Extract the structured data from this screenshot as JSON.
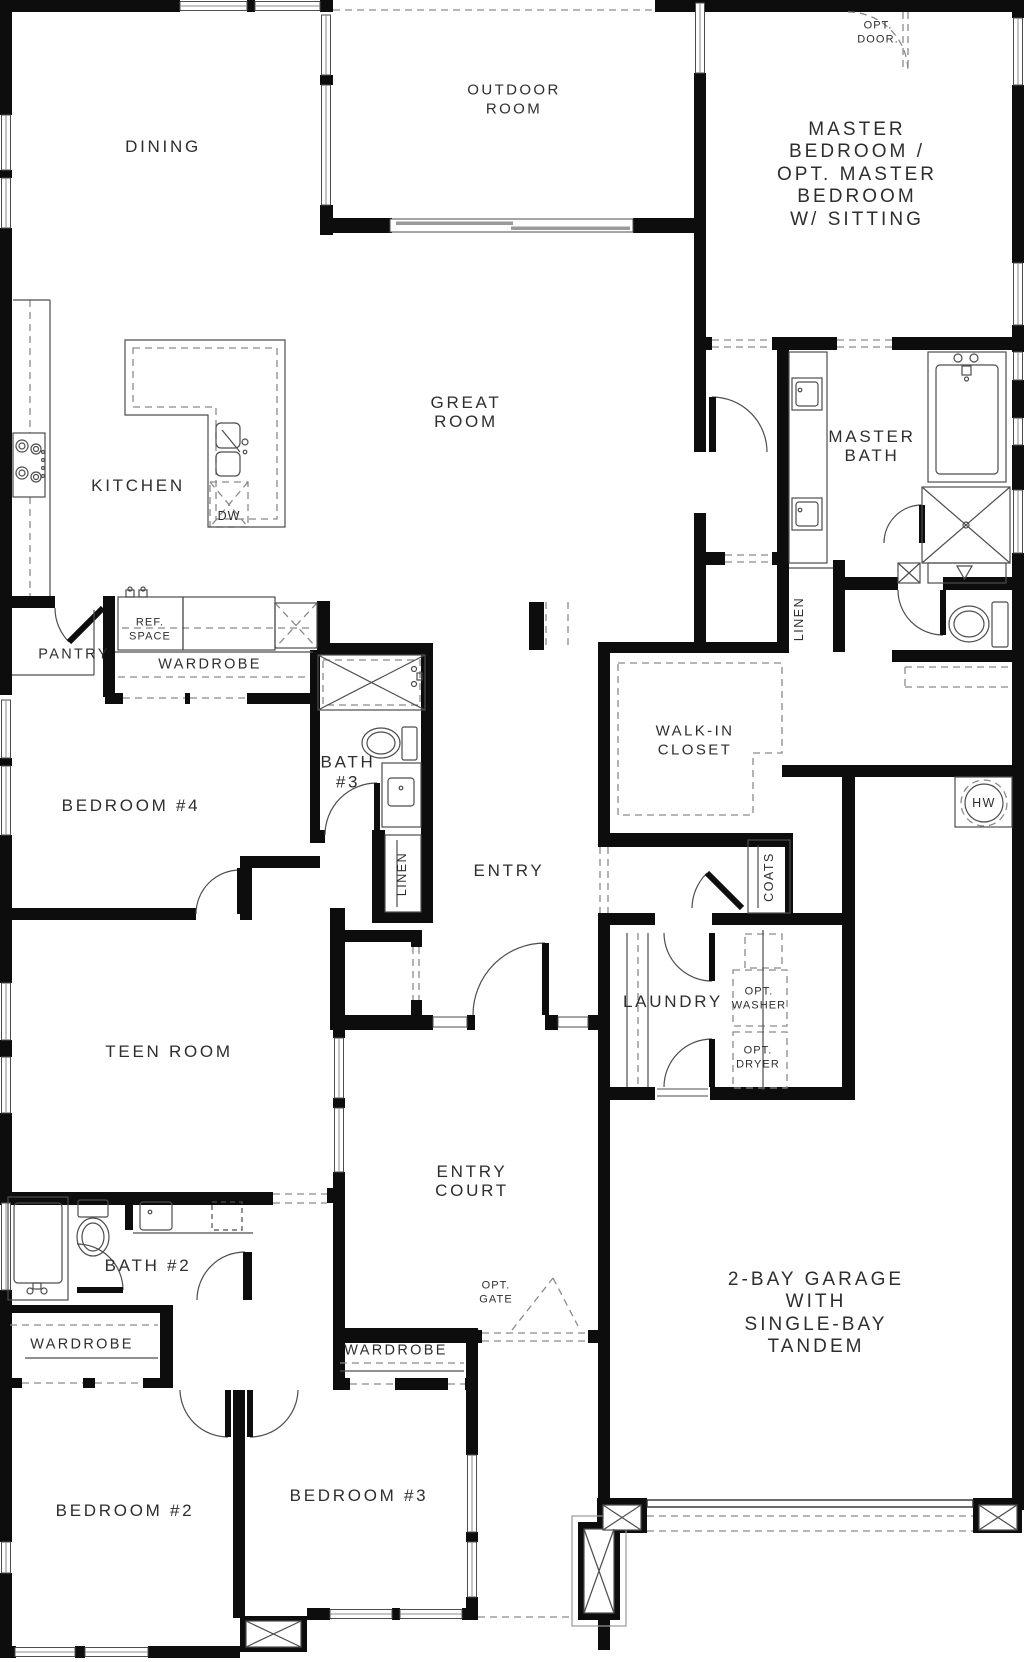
{
  "title": "single-story floor plan",
  "labels": {
    "dining": "DINING",
    "outdoor_room": "OUTDOOR\nROOM",
    "master_bedroom": "MASTER BEDROOM /\nOPT. MASTER BEDROOM\nW/ SITTING",
    "opt_door": "OPT.\nDOOR.",
    "great_room": "GREAT\nROOM",
    "kitchen": "KITCHEN",
    "dw": "DW",
    "ref_space": "REF.\nSPACE",
    "pantry": "PANTRY",
    "wardrobe_bed4": "WARDROBE",
    "master_bath": "MASTER\nBATH",
    "linen_master": "LINEN",
    "bedroom4": "BEDROOM #4",
    "bath3": "BATH\n#3",
    "linen_hall": "LINEN",
    "entry": "ENTRY",
    "walkin_closet": "WALK-IN\nCLOSET",
    "hw": "HW",
    "coats": "COATS",
    "laundry": "LAUNDRY",
    "opt_washer": "OPT.\nWASHER",
    "opt_dryer": "OPT.\nDRYER",
    "teen_room": "TEEN ROOM",
    "entry_court": "ENTRY\nCOURT",
    "bath2": "BATH #2",
    "wardrobe_bed2": "WARDROBE",
    "wardrobe_bed3": "WARDROBE",
    "opt_gate": "OPT.\nGATE",
    "garage": "2-BAY GARAGE\nWITH\nSINGLE-BAY TANDEM",
    "bedroom2": "BEDROOM #2",
    "bedroom3": "BEDROOM #3"
  },
  "colors": {
    "wall": "#0d0d0d",
    "thin_line": "#4d4d4d",
    "dashed_line": "#8a8a8a",
    "text": "#2e2e2e",
    "background": "#ffffff"
  }
}
